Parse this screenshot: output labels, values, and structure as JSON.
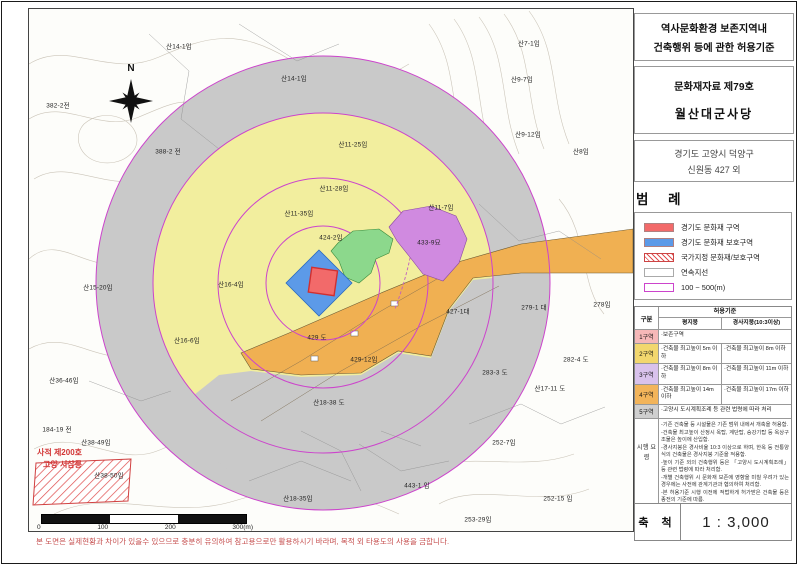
{
  "document": {
    "title_lines": [
      "역사문화환경 보존지역내",
      "건축행위 등에 관한 허용기준"
    ],
    "designation": "문화재자료 제79호",
    "site_name": "월산대군사당",
    "address_lines": [
      "경기도 고양시 덕양구",
      "신원동 427 외"
    ],
    "disclaimer": "본 도면은 실제현황과 차이가 있을수 있으므로 충분히 유의하여 참고용으로만 활용하시기 바라며, 목적 외 타용도의 사용을 금합니다."
  },
  "legend": {
    "title": "범 례",
    "items": [
      {
        "label": "경기도 문화재 구역",
        "swatch": "solid",
        "color": "#f26a6a"
      },
      {
        "label": "경기도 문화재 보호구역",
        "swatch": "solid",
        "color": "#5c9ae8"
      },
      {
        "label": "국가지정 문화재/보호구역",
        "swatch": "hatch"
      },
      {
        "label": "연속지선",
        "swatch": "outline-gray"
      },
      {
        "label": "100 ~ 500(m)",
        "swatch": "outline-magenta"
      }
    ]
  },
  "table": {
    "col_group": "구분",
    "col_standard": "허용기준",
    "col_flat": "평지붕",
    "col_slope": "경사지붕(10:3이상)",
    "rows": [
      {
        "zone": "1구역",
        "color": "#f6b8b8",
        "flat": "·보존구역",
        "span": true
      },
      {
        "zone": "2구역",
        "color": "#f2d76e",
        "flat": "·건축물 최고높이 5m 이하",
        "slope": "·건축물 최고높이 8m 이하"
      },
      {
        "zone": "3구역",
        "color": "#d9c2ec",
        "flat": "·건축물 최고높이 8m 이하",
        "slope": "·건축물 최고높이 11m 이하"
      },
      {
        "zone": "4구역",
        "color": "#f2b45a",
        "flat": "·건축물 최고높이 14m 이하",
        "slope": "·건축물 최고높이 17m 이하"
      },
      {
        "zone": "5구역",
        "color": "#cfcfcf",
        "flat": "·고양시 도시계획조례 등 관련 법령에 따라 처리",
        "span": true
      }
    ],
    "notes_label": "시행 요령",
    "notes": [
      {
        "t": "-기존 건축물 등 시설물은 기존 범위 내에서 개축을 허용함."
      },
      {
        "t": "-건축물 최고높이 산정시 옥탑, 계단탑, 승강기탑 등 옥상구조물은 높이에 산입함."
      },
      {
        "t": "-경사지붕은 경사비율 10:3 이상으로 하며, 한옥 등 전통양식의 건축물은 경사지붕 기준을 적용함."
      },
      {
        "t": "-높이 기준 외의 건축행위 등은 「고양시 도시계획조례」 등 관련 법령에 따라 처리함."
      },
      {
        "t": "-개별 건축행위 시 문화재 보존에 영향을 미칠 우려가 있는 경우에는 사전에 관계기관과 협의하여 처리함."
      },
      {
        "t": "-본 허용기준 시행 이전에 적법하게 허가받은 건축물 등은 종전의 기준에 따름."
      }
    ]
  },
  "scale": {
    "label": "축 척",
    "value": "1 : 3,000"
  },
  "scalebar": {
    "ticks": [
      {
        "t": "0"
      },
      {
        "t": "100"
      },
      {
        "t": "200"
      },
      {
        "t": "300(m)"
      }
    ]
  },
  "map": {
    "compass": "N",
    "colors": {
      "zone2_yellow": "#f2ee9e",
      "zone3_green": "#8cd88c",
      "zone3_purple": "#d08ae0",
      "zone4_orange": "#f0b052",
      "zone5_gray": "#c9c9c9",
      "protection_blue": "#5c9ae8",
      "heritage_red": "#f26a6a",
      "circle_magenta": "#cc44cc"
    },
    "heritage_annotation": [
      {
        "t": "사적 제200호",
        "x": 8,
        "y": 438
      },
      {
        "t": "고양 서삼릉",
        "x": 14,
        "y": 450
      }
    ],
    "labels": [
      {
        "text": "산14-1임",
        "x": 150,
        "y": 37
      },
      {
        "text": "382-2전",
        "x": 29,
        "y": 96
      },
      {
        "text": "산14-1임",
        "x": 265,
        "y": 69
      },
      {
        "text": "388-2 전",
        "x": 139,
        "y": 142
      },
      {
        "text": "산7-1임",
        "x": 500,
        "y": 34
      },
      {
        "text": "산9-7임",
        "x": 493,
        "y": 70
      },
      {
        "text": "산9-12임",
        "x": 499,
        "y": 125
      },
      {
        "text": "산8임",
        "x": 552,
        "y": 142
      },
      {
        "text": "산11-25임",
        "x": 324,
        "y": 135
      },
      {
        "text": "산11-28임",
        "x": 305,
        "y": 179
      },
      {
        "text": "산11-35임",
        "x": 270,
        "y": 204
      },
      {
        "text": "산11-7임",
        "x": 412,
        "y": 198
      },
      {
        "text": "424-2임",
        "x": 302,
        "y": 228
      },
      {
        "text": "433-9묘",
        "x": 400,
        "y": 233
      },
      {
        "text": "산15-20임",
        "x": 69,
        "y": 278
      },
      {
        "text": "산16-4임",
        "x": 202,
        "y": 275
      },
      {
        "text": "산16-6임",
        "x": 158,
        "y": 331
      },
      {
        "text": "427-1대",
        "x": 429,
        "y": 302
      },
      {
        "text": "279-1 대",
        "x": 505,
        "y": 298
      },
      {
        "text": "278임",
        "x": 573,
        "y": 295
      },
      {
        "text": "282-4 도",
        "x": 547,
        "y": 350
      },
      {
        "text": "283-3 도",
        "x": 466,
        "y": 363
      },
      {
        "text": "산17-11 도",
        "x": 521,
        "y": 379
      },
      {
        "text": "429 도",
        "x": 288,
        "y": 328
      },
      {
        "text": "429-12임",
        "x": 335,
        "y": 350
      },
      {
        "text": "산18-38 도",
        "x": 300,
        "y": 393
      },
      {
        "text": "산36-46임",
        "x": 35,
        "y": 371
      },
      {
        "text": "184-19 전",
        "x": 28,
        "y": 420
      },
      {
        "text": "산38-49임",
        "x": 67,
        "y": 433
      },
      {
        "text": "산38-50임",
        "x": 80,
        "y": 466
      },
      {
        "text": "산18-35임",
        "x": 269,
        "y": 489
      },
      {
        "text": "443-1 임",
        "x": 388,
        "y": 476
      },
      {
        "text": "252-7임",
        "x": 475,
        "y": 433
      },
      {
        "text": "252-15 임",
        "x": 529,
        "y": 489
      },
      {
        "text": "253-29임",
        "x": 449,
        "y": 510
      }
    ]
  }
}
